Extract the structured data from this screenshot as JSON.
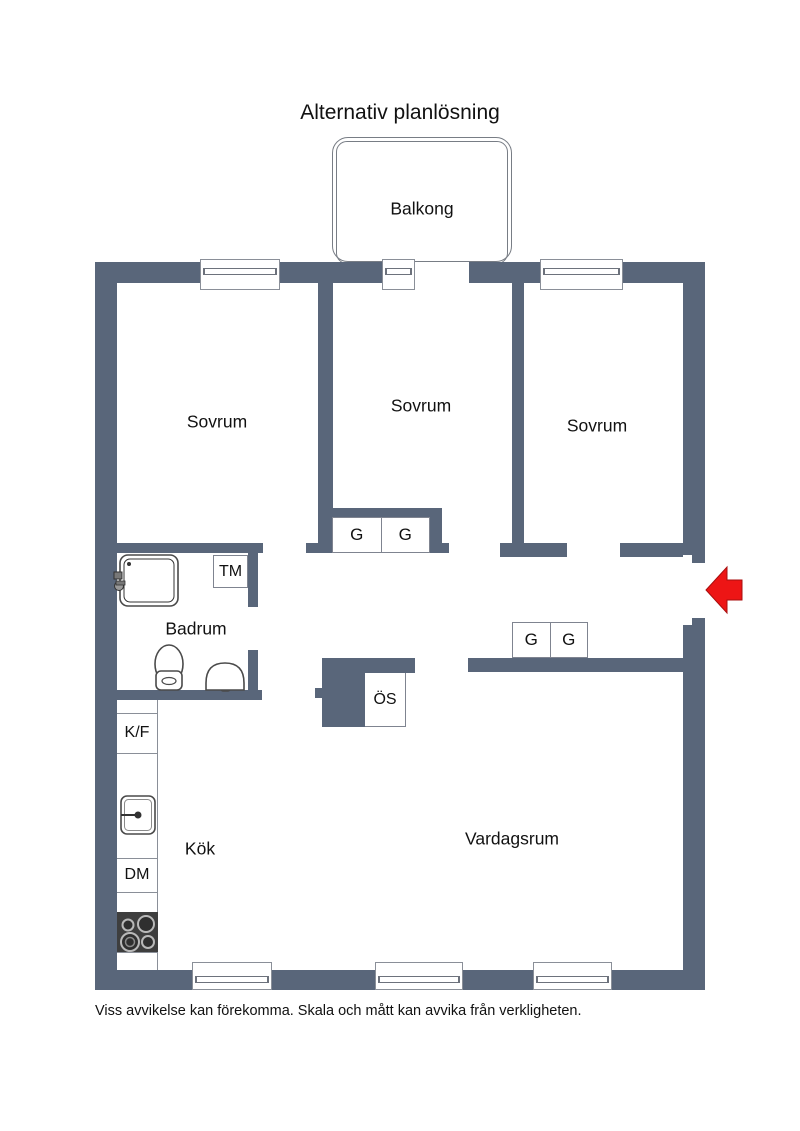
{
  "title": "Alternativ planlösning",
  "balcony": {
    "label": "Balkong"
  },
  "rooms": {
    "bedroom_left": {
      "label": "Sovrum"
    },
    "bedroom_middle": {
      "label": "Sovrum"
    },
    "bedroom_right": {
      "label": "Sovrum"
    },
    "bathroom": {
      "label": "Badrum"
    },
    "kitchen": {
      "label": "Kök"
    },
    "living_room": {
      "label": "Vardagsrum"
    }
  },
  "fixtures": {
    "washing_machine_label": "TM",
    "closets": [
      "G",
      "G",
      "G",
      "G"
    ],
    "fridge_freezer_label": "K/F",
    "dishwasher_label": "DM",
    "tiled_stove_label": "ÖS"
  },
  "colors": {
    "wall": "#59667a",
    "entry_arrow": "#ed1515"
  },
  "footer": "Viss avvikelse kan förekomma. Skala och mått kan avvika från verkligheten."
}
